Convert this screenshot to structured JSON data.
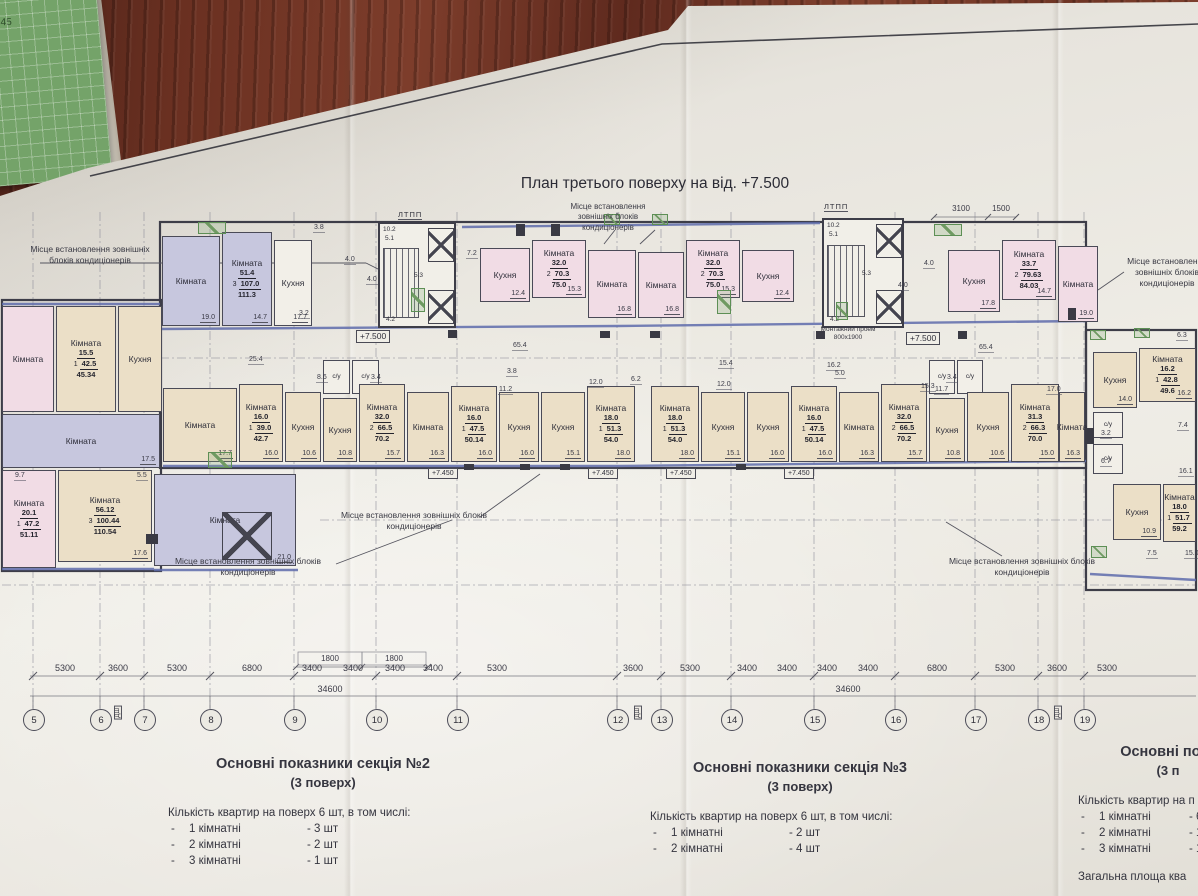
{
  "photo": {
    "title": "План третього поверху на від. +7.500",
    "handwritten_mark": "45"
  },
  "annotations": {
    "ac_note": "Місце встановлення зовнішніх блоків кондиціонерів",
    "ltpp": "ЛТПП",
    "montage": "Монтажний проем 800х1900",
    "level_main": "+7.500",
    "level_floor": "+7.450"
  },
  "rooms": [
    {
      "x": 2,
      "y": 306,
      "w": 52,
      "h": 106,
      "c": "P",
      "l": "Кімната"
    },
    {
      "x": 56,
      "y": 306,
      "w": 60,
      "h": 106,
      "c": "C",
      "l": "Кімната",
      "s": [
        "15.5",
        "1",
        "42.5",
        "45.34"
      ]
    },
    {
      "x": 118,
      "y": 306,
      "w": 44,
      "h": 106,
      "c": "C",
      "l": "Кухня"
    },
    {
      "x": 2,
      "y": 414,
      "w": 158,
      "h": 54,
      "c": "L",
      "l": "Кімната",
      "a": "17.5"
    },
    {
      "x": 2,
      "y": 470,
      "w": 54,
      "h": 98,
      "c": "P",
      "l": "Кімната",
      "s": [
        "20.1",
        "1",
        "47.2",
        "51.11"
      ]
    },
    {
      "x": 58,
      "y": 470,
      "w": 94,
      "h": 92,
      "c": "C",
      "l": "Кімната",
      "a": "17.6",
      "s": [
        "56.12",
        "3",
        "100.44",
        "110.54"
      ]
    },
    {
      "x": 154,
      "y": 474,
      "w": 142,
      "h": 92,
      "c": "L",
      "l": "Кімната",
      "a": "21.0"
    },
    {
      "x": 162,
      "y": 236,
      "w": 58,
      "h": 90,
      "c": "L",
      "l": "Кімната",
      "a": "19.0"
    },
    {
      "x": 222,
      "y": 232,
      "w": 50,
      "h": 94,
      "c": "L",
      "l": "Кімната",
      "a": "14.7",
      "s": [
        "51.4",
        "3",
        "107.0",
        "111.3"
      ]
    },
    {
      "x": 274,
      "y": 240,
      "w": 38,
      "h": 86,
      "c": "W",
      "l": "Кухня",
      "a": "17.7"
    },
    {
      "x": 480,
      "y": 248,
      "w": 50,
      "h": 54,
      "c": "P",
      "l": "Кухня",
      "a": "12.4"
    },
    {
      "x": 532,
      "y": 240,
      "w": 54,
      "h": 58,
      "c": "P",
      "l": "Кімната",
      "a": "15.3",
      "s": [
        "32.0",
        "2",
        "70.3",
        "75.0"
      ]
    },
    {
      "x": 588,
      "y": 250,
      "w": 48,
      "h": 68,
      "c": "P",
      "l": "Кімната",
      "a": "16.8"
    },
    {
      "x": 638,
      "y": 252,
      "w": 46,
      "h": 66,
      "c": "P",
      "l": "Кімната",
      "a": "16.8"
    },
    {
      "x": 686,
      "y": 240,
      "w": 54,
      "h": 58,
      "c": "P",
      "l": "Кімната",
      "a": "15.3",
      "s": [
        "32.0",
        "2",
        "70.3",
        "75.0"
      ]
    },
    {
      "x": 742,
      "y": 250,
      "w": 52,
      "h": 52,
      "c": "P",
      "l": "Кухня",
      "a": "12.4"
    },
    {
      "x": 948,
      "y": 250,
      "w": 52,
      "h": 62,
      "c": "P",
      "l": "Кухня",
      "a": "17.8"
    },
    {
      "x": 1002,
      "y": 240,
      "w": 54,
      "h": 60,
      "c": "P",
      "l": "Кімната",
      "a": "14.7",
      "s": [
        "33.7",
        "2",
        "79.63",
        "84.03"
      ]
    },
    {
      "x": 1058,
      "y": 246,
      "w": 40,
      "h": 76,
      "c": "P",
      "l": "Кімната",
      "a": "19.0"
    },
    {
      "x": 163,
      "y": 388,
      "w": 74,
      "h": 74,
      "c": "C",
      "l": "Кімната",
      "a": "17.7"
    },
    {
      "x": 239,
      "y": 384,
      "w": 44,
      "h": 78,
      "c": "C",
      "l": "Кімната",
      "a": "16.0",
      "s": [
        "16.0",
        "1",
        "39.0",
        "42.7"
      ]
    },
    {
      "x": 285,
      "y": 392,
      "w": 36,
      "h": 70,
      "c": "C",
      "l": "Кухня",
      "a": "10.6"
    },
    {
      "x": 323,
      "y": 360,
      "w": 27,
      "h": 34,
      "c": "W",
      "l": "с/у"
    },
    {
      "x": 352,
      "y": 360,
      "w": 27,
      "h": 34,
      "c": "W",
      "l": "с/у"
    },
    {
      "x": 323,
      "y": 398,
      "w": 34,
      "h": 64,
      "c": "C",
      "l": "Кухня",
      "a": "10.8"
    },
    {
      "x": 359,
      "y": 384,
      "w": 46,
      "h": 78,
      "c": "C",
      "l": "Кімната",
      "a": "15.7",
      "s": [
        "32.0",
        "2",
        "66.5",
        "70.2"
      ]
    },
    {
      "x": 407,
      "y": 392,
      "w": 42,
      "h": 70,
      "c": "C",
      "l": "Кімната",
      "a": "16.3"
    },
    {
      "x": 451,
      "y": 386,
      "w": 46,
      "h": 76,
      "c": "C",
      "l": "Кімната",
      "a": "16.0",
      "s": [
        "16.0",
        "1",
        "47.5",
        "50.14"
      ]
    },
    {
      "x": 499,
      "y": 392,
      "w": 40,
      "h": 70,
      "c": "C",
      "l": "Кухня",
      "a": "16.0"
    },
    {
      "x": 541,
      "y": 392,
      "w": 44,
      "h": 70,
      "c": "C",
      "l": "Кухня",
      "a": "15.1"
    },
    {
      "x": 587,
      "y": 386,
      "w": 48,
      "h": 76,
      "c": "C",
      "l": "Кімната",
      "a": "18.0",
      "s": [
        "18.0",
        "1",
        "51.3",
        "54.0"
      ]
    },
    {
      "x": 651,
      "y": 386,
      "w": 48,
      "h": 76,
      "c": "C",
      "l": "Кімната",
      "a": "18.0",
      "s": [
        "18.0",
        "1",
        "51.3",
        "54.0"
      ]
    },
    {
      "x": 701,
      "y": 392,
      "w": 44,
      "h": 70,
      "c": "C",
      "l": "Кухня",
      "a": "15.1"
    },
    {
      "x": 747,
      "y": 392,
      "w": 42,
      "h": 70,
      "c": "C",
      "l": "Кухня",
      "a": "16.0"
    },
    {
      "x": 791,
      "y": 386,
      "w": 46,
      "h": 76,
      "c": "C",
      "l": "Кімната",
      "a": "16.0",
      "s": [
        "16.0",
        "1",
        "47.5",
        "50.14"
      ]
    },
    {
      "x": 839,
      "y": 392,
      "w": 40,
      "h": 70,
      "c": "C",
      "l": "Кімната",
      "a": "16.3"
    },
    {
      "x": 881,
      "y": 384,
      "w": 46,
      "h": 78,
      "c": "C",
      "l": "Кімната",
      "a": "15.7",
      "s": [
        "32.0",
        "2",
        "66.5",
        "70.2"
      ]
    },
    {
      "x": 929,
      "y": 398,
      "w": 36,
      "h": 64,
      "c": "C",
      "l": "Кухня",
      "a": "10.8"
    },
    {
      "x": 929,
      "y": 360,
      "w": 26,
      "h": 34,
      "c": "W",
      "l": "с/у"
    },
    {
      "x": 957,
      "y": 360,
      "w": 26,
      "h": 34,
      "c": "W",
      "l": "с/у"
    },
    {
      "x": 967,
      "y": 392,
      "w": 42,
      "h": 70,
      "c": "C",
      "l": "Кухня",
      "a": "10.6"
    },
    {
      "x": 1011,
      "y": 384,
      "w": 48,
      "h": 78,
      "c": "C",
      "l": "Кімната",
      "a": "15.0",
      "s": [
        "31.3",
        "2",
        "66.3",
        "70.0"
      ]
    },
    {
      "x": 1059,
      "y": 392,
      "w": 26,
      "h": 70,
      "c": "C",
      "l": "Кімната",
      "a": "16.3"
    },
    {
      "x": 1093,
      "y": 352,
      "w": 44,
      "h": 56,
      "c": "C",
      "l": "Кухня",
      "a": "14.0"
    },
    {
      "x": 1139,
      "y": 348,
      "w": 57,
      "h": 54,
      "c": "C",
      "l": "Кімната",
      "a": "16.2",
      "s": [
        "16.2",
        "1",
        "42.8",
        "49.6"
      ]
    },
    {
      "x": 1093,
      "y": 412,
      "w": 30,
      "h": 26,
      "c": "W",
      "l": "с/у"
    },
    {
      "x": 1093,
      "y": 444,
      "w": 30,
      "h": 30,
      "c": "W",
      "l": "с/у"
    },
    {
      "x": 1113,
      "y": 484,
      "w": 48,
      "h": 56,
      "c": "C",
      "l": "Кухня",
      "a": "10.9"
    },
    {
      "x": 1163,
      "y": 484,
      "w": 33,
      "h": 58,
      "c": "C",
      "l": "Кімната",
      "s": [
        "18.0",
        "1",
        "51.7",
        "59.2"
      ]
    }
  ],
  "cores": [
    {
      "x": 378,
      "y": 222,
      "w": 78,
      "h": 106,
      "dims": [
        "10.2",
        "5.1",
        "4.2",
        "5.3"
      ]
    },
    {
      "x": 822,
      "y": 218,
      "w": 82,
      "h": 110,
      "dims": [
        "10.2",
        "5.1",
        "4.2",
        "5.3"
      ]
    }
  ],
  "ltpp_positions": [
    {
      "x": 398,
      "y": 210
    },
    {
      "x": 824,
      "y": 202
    }
  ],
  "levels": [
    {
      "x": 356,
      "y": 330,
      "v": "+7.500",
      "small": false
    },
    {
      "x": 906,
      "y": 332,
      "v": "+7.500",
      "small": false
    },
    {
      "x": 428,
      "y": 468,
      "v": "+7.450",
      "small": true
    },
    {
      "x": 588,
      "y": 468,
      "v": "+7.450",
      "small": true
    },
    {
      "x": 666,
      "y": 468,
      "v": "+7.450",
      "small": true
    },
    {
      "x": 784,
      "y": 468,
      "v": "+7.450",
      "small": true
    }
  ],
  "smalls": [
    {
      "x": 313,
      "y": 224,
      "v": "3.8"
    },
    {
      "x": 466,
      "y": 250,
      "v": "7.2"
    },
    {
      "x": 512,
      "y": 342,
      "v": "65.4"
    },
    {
      "x": 978,
      "y": 344,
      "v": "65.4"
    },
    {
      "x": 248,
      "y": 356,
      "v": "25.4"
    },
    {
      "x": 718,
      "y": 360,
      "v": "15.4"
    },
    {
      "x": 826,
      "y": 362,
      "v": "16.2"
    },
    {
      "x": 588,
      "y": 379,
      "v": "12.0"
    },
    {
      "x": 716,
      "y": 381,
      "v": "12.0"
    },
    {
      "x": 630,
      "y": 376,
      "v": "6.2"
    },
    {
      "x": 834,
      "y": 370,
      "v": "5.0"
    },
    {
      "x": 920,
      "y": 383,
      "v": "15.3"
    },
    {
      "x": 1046,
      "y": 386,
      "v": "17.0"
    },
    {
      "x": 316,
      "y": 374,
      "v": "8.6"
    },
    {
      "x": 370,
      "y": 374,
      "v": "3.4"
    },
    {
      "x": 946,
      "y": 374,
      "v": "3.4"
    },
    {
      "x": 1176,
      "y": 332,
      "v": "6.3"
    },
    {
      "x": 1177,
      "y": 422,
      "v": "7.4"
    },
    {
      "x": 1178,
      "y": 468,
      "v": "16.1"
    },
    {
      "x": 1146,
      "y": 550,
      "v": "7.5"
    },
    {
      "x": 1184,
      "y": 550,
      "v": "15.0"
    },
    {
      "x": 14,
      "y": 472,
      "v": "9.7"
    },
    {
      "x": 136,
      "y": 472,
      "v": "5.5"
    },
    {
      "x": 506,
      "y": 368,
      "v": "3.8"
    },
    {
      "x": 498,
      "y": 386,
      "v": "11.2"
    },
    {
      "x": 934,
      "y": 386,
      "v": "11.7"
    },
    {
      "x": 897,
      "y": 282,
      "v": "4.0"
    },
    {
      "x": 923,
      "y": 260,
      "v": "4.0"
    },
    {
      "x": 344,
      "y": 256,
      "v": "4.0"
    },
    {
      "x": 366,
      "y": 276,
      "v": "4.0"
    },
    {
      "x": 298,
      "y": 310,
      "v": "3.2"
    },
    {
      "x": 1100,
      "y": 430,
      "v": "3.2"
    },
    {
      "x": 1100,
      "y": 458,
      "v": "6.7"
    }
  ],
  "notes": [
    {
      "x": 24,
      "y": 244,
      "w": 132
    },
    {
      "x": 556,
      "y": 202,
      "w": 104
    },
    {
      "x": 330,
      "y": 510,
      "w": 168
    },
    {
      "x": 158,
      "y": 556,
      "w": 180
    },
    {
      "x": 946,
      "y": 556,
      "w": 152
    },
    {
      "x": 1124,
      "y": 256,
      "w": 86
    }
  ],
  "dimensions": {
    "row": [
      {
        "x": 65,
        "v": "5300"
      },
      {
        "x": 118,
        "v": "3600"
      },
      {
        "x": 177,
        "v": "5300"
      },
      {
        "x": 252,
        "v": "6800"
      },
      {
        "x": 312,
        "v": "3400"
      },
      {
        "x": 353,
        "v": "3400"
      },
      {
        "x": 395,
        "v": "3400"
      },
      {
        "x": 433,
        "v": "3400"
      },
      {
        "x": 497,
        "v": "5300"
      },
      {
        "x": 633,
        "v": "3600"
      },
      {
        "x": 690,
        "v": "5300"
      },
      {
        "x": 747,
        "v": "3400"
      },
      {
        "x": 787,
        "v": "3400"
      },
      {
        "x": 827,
        "v": "3400"
      },
      {
        "x": 868,
        "v": "3400"
      },
      {
        "x": 937,
        "v": "6800"
      },
      {
        "x": 1005,
        "v": "5300"
      },
      {
        "x": 1057,
        "v": "3600"
      },
      {
        "x": 1107,
        "v": "5300"
      }
    ],
    "totals": [
      {
        "x": 330,
        "v": "34600"
      },
      {
        "x": 848,
        "v": "34600"
      }
    ],
    "top": [
      {
        "x": 330,
        "y": 654,
        "v": "1800"
      },
      {
        "x": 394,
        "y": 654,
        "v": "1800"
      },
      {
        "x": 961,
        "y": 204,
        "v": "3100"
      },
      {
        "x": 1001,
        "y": 204,
        "v": "1500"
      }
    ]
  },
  "axes": [
    {
      "x": 33,
      "n": "5"
    },
    {
      "x": 100,
      "n": "6"
    },
    {
      "x": 144,
      "n": "7"
    },
    {
      "x": 210,
      "n": "8"
    },
    {
      "x": 294,
      "n": "9"
    },
    {
      "x": 376,
      "n": "10"
    },
    {
      "x": 457,
      "n": "11"
    },
    {
      "x": 617,
      "n": "12"
    },
    {
      "x": 661,
      "n": "13"
    },
    {
      "x": 731,
      "n": "14"
    },
    {
      "x": 814,
      "n": "15"
    },
    {
      "x": 895,
      "n": "16"
    },
    {
      "x": 975,
      "n": "17"
    },
    {
      "x": 1038,
      "n": "18"
    },
    {
      "x": 1084,
      "n": "19"
    }
  ],
  "joints": {
    "label": "ДШ",
    "x": [
      114,
      634,
      1054
    ]
  },
  "summaries": [
    {
      "title": "Основні показники секція №2",
      "sub": "(3 поверх)",
      "intro": "Кількість квартир на поверх 6 шт, в том числі:",
      "items": [
        {
          "n": "1 кімнатні",
          "c": "3 шт"
        },
        {
          "n": "2 кімнатні",
          "c": "2 шт"
        },
        {
          "n": "3 кімнатні",
          "c": "1 шт"
        }
      ]
    },
    {
      "title": "Основні показники секція №3",
      "sub": "(3 поверх)",
      "intro": "Кількість квартир на поверх 6 шт, в том числі:",
      "items": [
        {
          "n": "1 кімнатні",
          "c": "2 шт"
        },
        {
          "n": "2 кімнатні",
          "c": "4 шт"
        }
      ]
    },
    {
      "title": "Основні пока",
      "sub": "(3 п",
      "intro": "Кількість квартир на п",
      "items": [
        {
          "n": "1 кімнатні",
          "c": "6"
        },
        {
          "n": "2 кімнатні",
          "c": "1"
        },
        {
          "n": "3 кімнатні",
          "c": "1"
        }
      ],
      "footer": "Загальна площа ква"
    }
  ],
  "colors": {
    "lavender": "#c7c7de",
    "pink": "#f1dce5",
    "cream": "#ebdfc7",
    "facade_blue": "#5f6cac",
    "ac_green": "#5d8f55",
    "paper": "#ebe8e1",
    "wood": "#6b3122"
  }
}
